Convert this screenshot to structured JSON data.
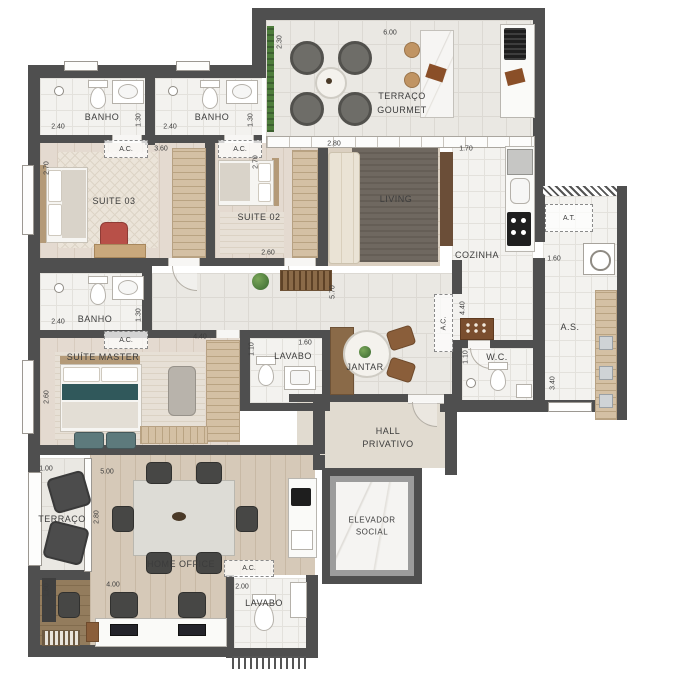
{
  "plan_type": "apartment-floor-plan",
  "labels": {
    "banho": "BANHO",
    "suite03": "SUITE 03",
    "suite02": "SUITE 02",
    "suite_master": "SUÍTE MASTER",
    "terraco_gourmet_1": "TERRAÇO",
    "terraco_gourmet_2": "GOURMET",
    "living": "LIVING",
    "cozinha": "COZINHA",
    "at": "A.T.",
    "as": "A.S.",
    "wc": "W.C.",
    "lavabo": "LAVABO",
    "jantar": "JANTAR",
    "hall_1": "HALL",
    "hall_2": "PRIVATIVO",
    "terraco": "TERRAÇO",
    "home_office": "HOME OFFICE",
    "elevador_1": "ELEVADOR",
    "elevador_2": "SOCIAL",
    "ac": "A.C."
  },
  "dims": {
    "d100": "1.00",
    "d110": "1.10",
    "d130": "1.30",
    "d160": "1.60",
    "d170": "1.70",
    "d200": "2.00",
    "d230": "2.30",
    "d240": "2.40",
    "d260": "2.60",
    "d270": "2.70",
    "d280": "2.80",
    "d340": "3.40",
    "d360": "3.60",
    "d400": "4.00",
    "d440": "4.40",
    "d500": "5.00",
    "d570": "5.70",
    "d600": "6.00"
  },
  "colors": {
    "wall": "#4f4f4f",
    "planter_green": "#4e7d3c",
    "accent_teal": "#30585b",
    "accent_red": "#b85048",
    "wood": "#d4c0a4"
  }
}
